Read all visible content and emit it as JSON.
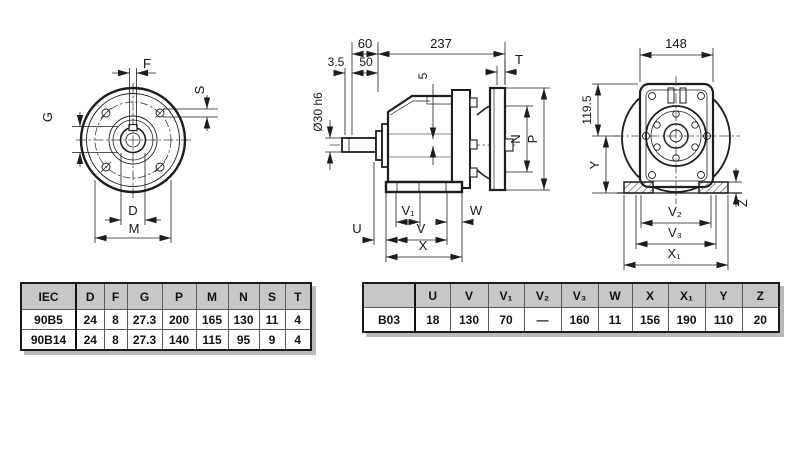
{
  "views": {
    "front": {
      "f": "F",
      "s": "S",
      "g": "G",
      "d": "D",
      "m": "M"
    },
    "side": {
      "d60": "60",
      "d237": "237",
      "d35": "3.5",
      "d50": "50",
      "d5": "5",
      "t": "T",
      "shaft_dia": "Ø30 h6",
      "n": "N",
      "p": "P",
      "u": "U",
      "v": "V",
      "v1": "V₁",
      "w": "W",
      "x": "X"
    },
    "rear": {
      "d148": "148",
      "d119": "119.5",
      "y": "Y",
      "v2": "V₂",
      "v3": "V₃",
      "x1": "X₁",
      "z": "Z"
    }
  },
  "iec_table": {
    "col0_header": "IEC",
    "headers": [
      "D",
      "F",
      "G",
      "P",
      "M",
      "N",
      "S",
      "T"
    ],
    "rows": [
      {
        "label": "90B5",
        "values": [
          "24",
          "8",
          "27.3",
          "200",
          "165",
          "130",
          "11",
          "4"
        ]
      },
      {
        "label": "90B14",
        "values": [
          "24",
          "8",
          "27.3",
          "140",
          "115",
          "95",
          "9",
          "4"
        ]
      }
    ]
  },
  "dim_table": {
    "col0_header": "",
    "headers": [
      "U",
      "V",
      "V₁",
      "V₂",
      "V₃",
      "W",
      "X",
      "X₁",
      "Y",
      "Z"
    ],
    "rows": [
      {
        "label": "B03",
        "values": [
          "18",
          "130",
          "70",
          "—",
          "160",
          "11",
          "156",
          "190",
          "110",
          "20"
        ]
      }
    ]
  },
  "colors": {
    "line": "#1d1d1d",
    "table_header_bg": "#c7c7c7",
    "table_shadow": "#b8b8b8"
  }
}
